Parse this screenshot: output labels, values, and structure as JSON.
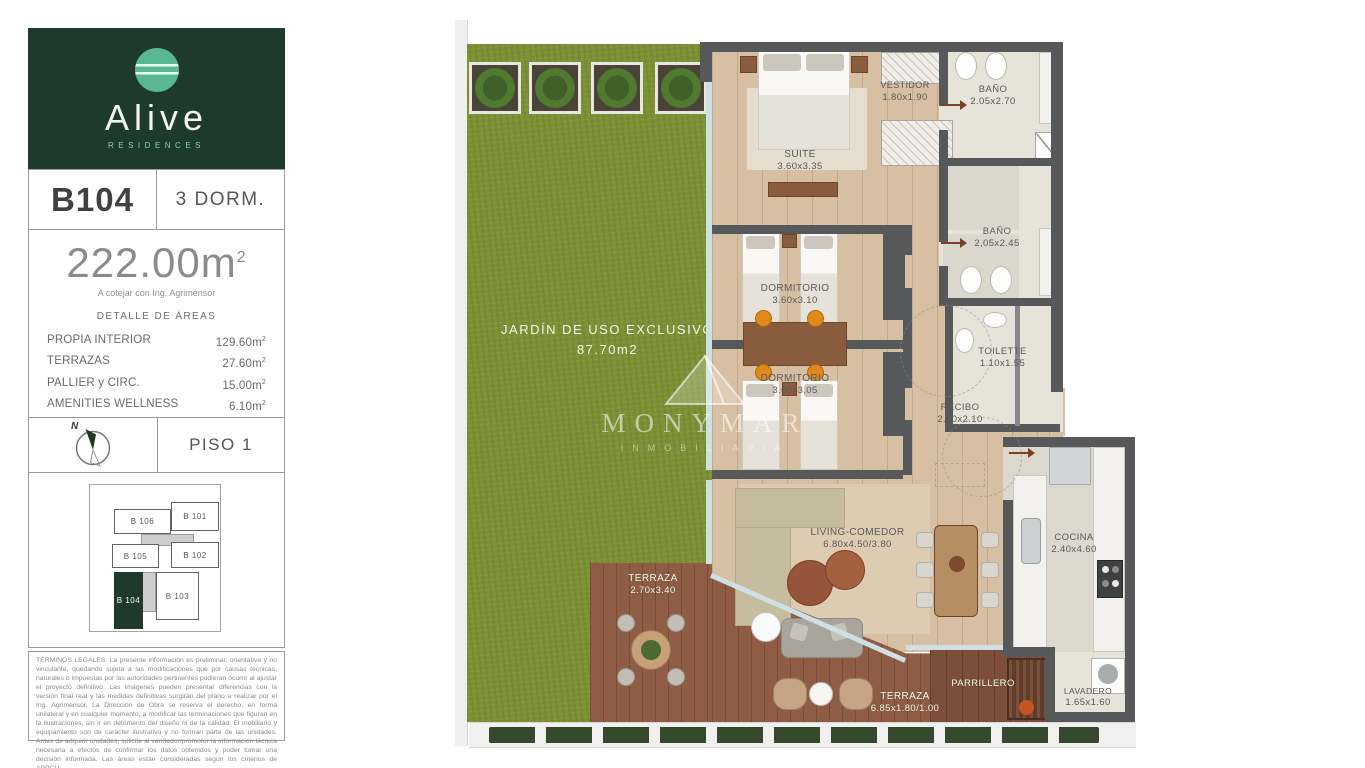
{
  "sidebar": {
    "brand": {
      "name": "Alive",
      "tagline": "RESIDENCES"
    },
    "unit": {
      "code": "B104",
      "type": "3 DORM."
    },
    "area": {
      "total": "222.00m",
      "sup": "2",
      "note": "A cotejar con Ing. Agrimensor",
      "detail_title": "DETALLE DE ÁREAS",
      "rows": [
        {
          "label": "PROPIA INTERIOR",
          "value": "129.60m"
        },
        {
          "label": "TERRAZAS",
          "value": "27.60m"
        },
        {
          "label": "PALLIER y CIRC.",
          "value": "15.00m"
        },
        {
          "label": "AMENITIES WELLNESS",
          "value": "6.10m"
        },
        {
          "label": "JARDÍN (NO COMPUTA)",
          "value": "87.70m"
        }
      ]
    },
    "floor": {
      "compass_label": "N",
      "label": "PISO 1"
    },
    "keyplan": {
      "units": [
        {
          "label": "B 106"
        },
        {
          "label": "B 101"
        },
        {
          "label": "B 105"
        },
        {
          "label": "B 102"
        },
        {
          "label": "B 104"
        },
        {
          "label": "B 103"
        }
      ],
      "highlighted": "B 104"
    },
    "legal": "TÉRMINOS LEGALES: La presente información es preliminar, orientativa y no vinculante, quedando sujeta a las modificaciones que por causas técnicas, naturales o impuestas por las autoridades pertinentes pudieran ocurrir al ajustar el proyecto definitivo. Las imágenes pueden presentar diferencias con la versión final real y las medidas definitivas surgirán del plano a realizar por el Ing. Agrimensor. La Dirección de Obra se reserva el derecho, en forma unilateral y en cualquier momento, a modificar las terminaciones que figuran en la ilustraciones, sin ir en detrimento del diseño ni de la calidad. El mobiliario y equipamiento son de carácter ilustrativo y no forman parte de las unidades. Antes de adquirir unidades, solicite al vendedor/promotor la información técnica necesaria a efectos de confirmar los datos obtenidos y poder tomar una decisión informada. Las áreas están consideradas según los criterios de APPCU."
  },
  "plan": {
    "garden": {
      "label": "JARDÍN DE USO EXCLUSIVO",
      "area": "87.70m2"
    },
    "rooms": [
      {
        "name": "SUITE",
        "dims": "3.60x3.35"
      },
      {
        "name": "VESTIDOR",
        "dims": "1.80x1.90"
      },
      {
        "name": "BAÑO",
        "dims": "2.05x2.70"
      },
      {
        "name": "BAÑO",
        "dims": "2,05x2.45"
      },
      {
        "name": "DORMITORIO",
        "dims": "3.60x3.10"
      },
      {
        "name": "DORMITORIO",
        "dims": "3.60x3.05"
      },
      {
        "name": "TOILETTE",
        "dims": "1.10x1.55"
      },
      {
        "name": "RECIBO",
        "dims": "2.40x2.10"
      },
      {
        "name": "LIVING-COMEDOR",
        "dims": "6.80x4.50/3.80"
      },
      {
        "name": "COCINA",
        "dims": "2.40x4.60"
      },
      {
        "name": "TERRAZA",
        "dims": "2.70x3.40"
      },
      {
        "name": "TERRAZA",
        "dims": "6.85x1.80/1.00"
      },
      {
        "name": "PARRILLERO",
        "dims": ""
      },
      {
        "name": "LAVADERO",
        "dims": "1.65x1.60"
      }
    ],
    "watermark": {
      "name": "MONYMAR",
      "sub": "INMOBILIARIA"
    }
  },
  "colors": {
    "brand_green": "#1d3a2b",
    "brand_teal": "#58b894",
    "wall_gray": "#57585a",
    "grass": "#7d9037",
    "wood_floor": "#d6bfa2",
    "deck_wood": "#8f5d45",
    "tile": "#e6e3d9"
  }
}
